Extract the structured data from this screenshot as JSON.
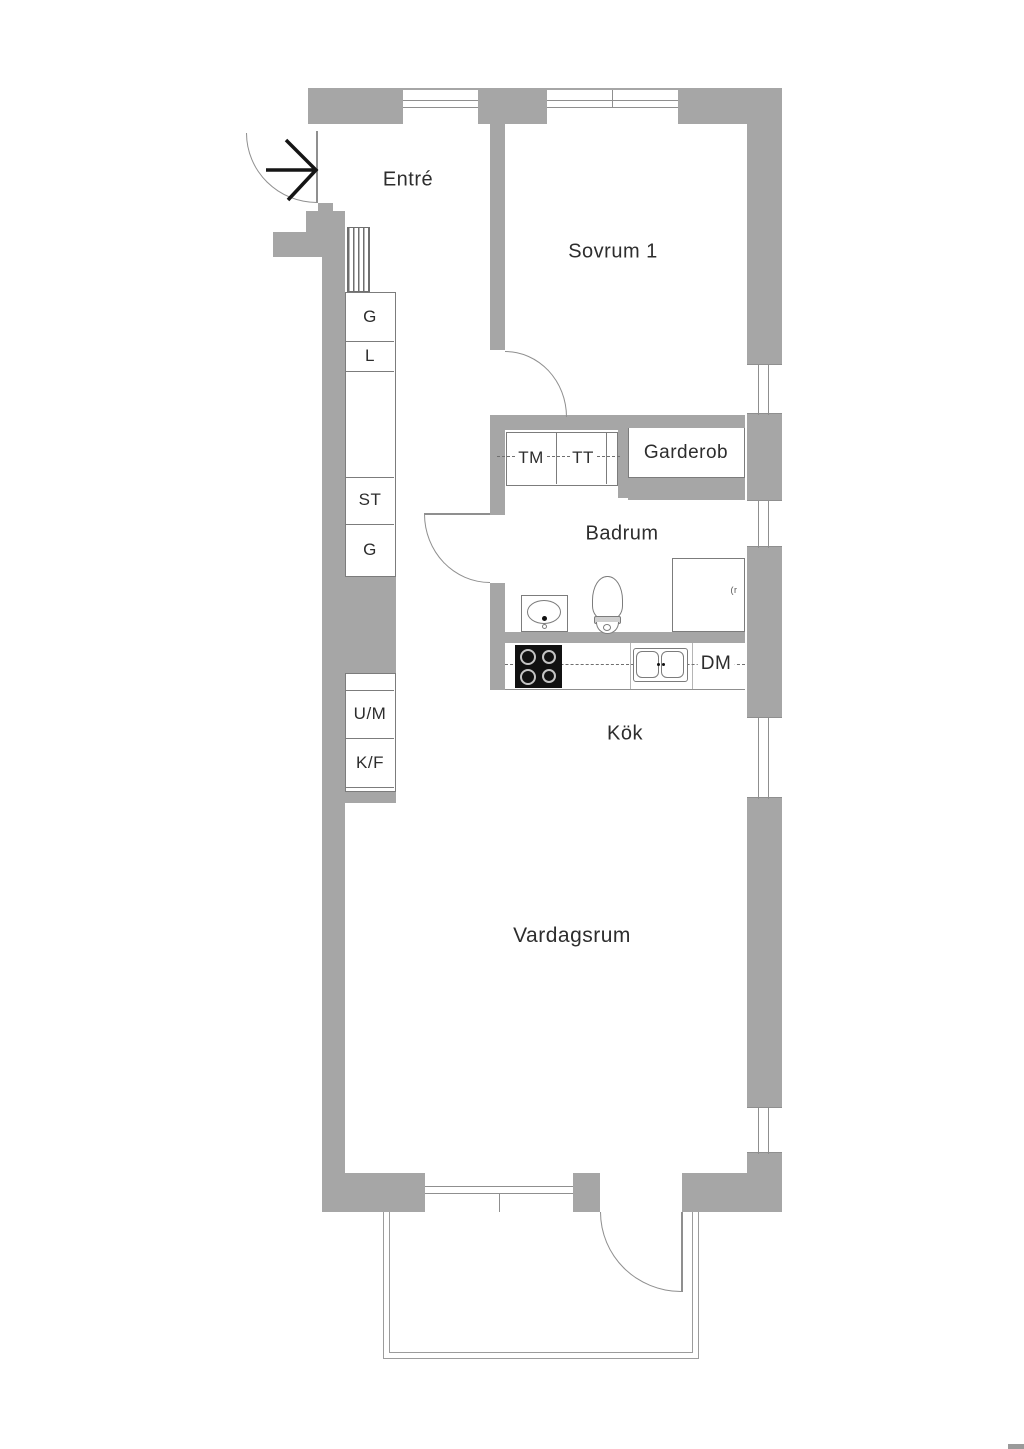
{
  "title": "Lägenhetsplanritning",
  "rooms": {
    "entre": "Entré",
    "sovrum1": "Sovrum 1",
    "garderob": "Garderob",
    "badrum": "Badrum",
    "kok": "Kök",
    "vardagsrum": "Vardagsrum"
  },
  "storage": {
    "g1": "G",
    "l": "L",
    "st": "ST",
    "g2": "G",
    "um": "U/M",
    "kf": "K/F"
  },
  "appliances": {
    "tm": "TM",
    "tt": "TT",
    "dm": "DM"
  },
  "annotations": {
    "shower_mark": "(r"
  },
  "colors": {
    "wall": "#a6a6a6",
    "outline": "#7c7c7c",
    "doorline": "#8f8f8f",
    "balcony": "#9c9c9c",
    "text": "#2d2d2d"
  }
}
